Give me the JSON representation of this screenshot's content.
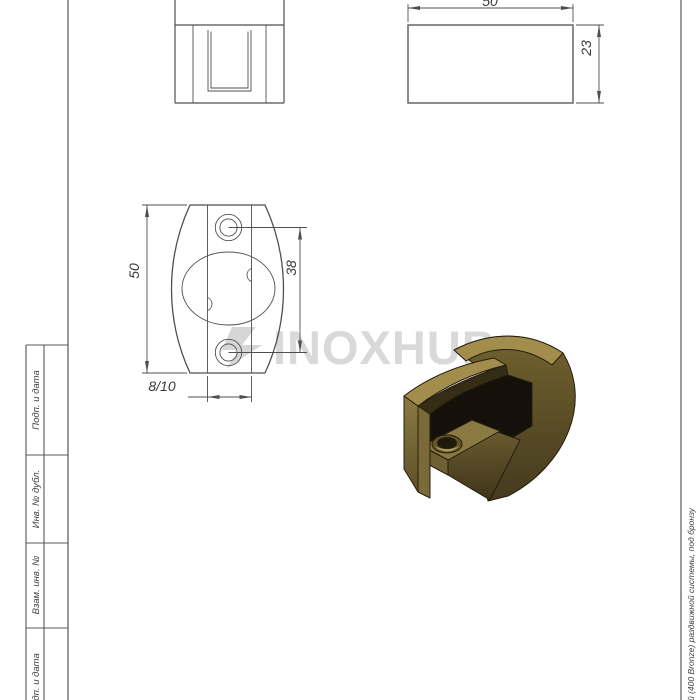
{
  "drawing": {
    "dimensions": {
      "side_view_width": "50",
      "side_view_height": "23",
      "plan_view_height": "50",
      "hole_spacing": "38",
      "glass_thickness": "8/10"
    }
  },
  "title_block": {
    "labels": [
      "Подп. и дата",
      "Инв. № дубл.",
      "Взам. инв. №",
      "Подп. и дата"
    ]
  },
  "side_note": {
    "text": "й (400 Bronze) раздвижной системы, под бронзу"
  },
  "watermark": {
    "text": "INOXHUB",
    "color": "#d9d9d9"
  },
  "part_render": {
    "label": "bronze glass clamp 3D render",
    "colors": {
      "top_face": "#a28d4c",
      "rim_light": "#a28d4c",
      "outer_face_top": "#72622f",
      "outer_face_bottom": "#443a1e",
      "front_face": "#8c7b42",
      "inner_shadow": "#362d16",
      "slot": "#15110a",
      "floor": "#8a7940",
      "floor_edge": "#6f5f32",
      "hole_ring": "#645527",
      "hole_dark": "#1f1a0e",
      "hole_highlight": "#b09a5c",
      "line": "#4f4f4f"
    }
  }
}
